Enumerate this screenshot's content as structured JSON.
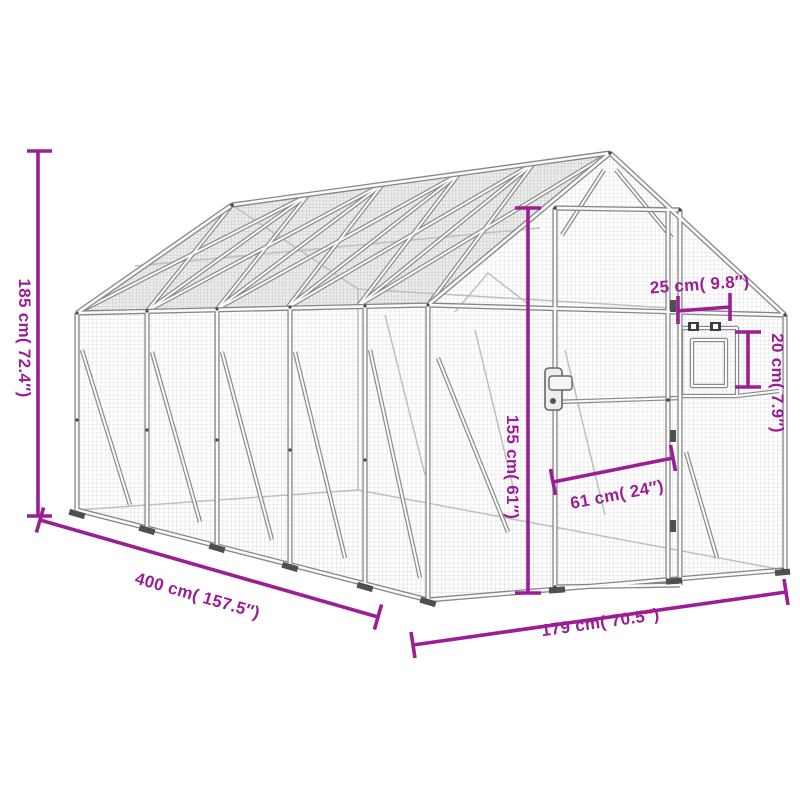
{
  "diagram": {
    "kind": "product-dimension-diagram",
    "subject": "aviary-cage-line-drawing"
  },
  "dimensions": {
    "overall_height": {
      "label": "185 cm( 72.4″)",
      "value_cm": 185,
      "value_in": 72.4
    },
    "overall_length": {
      "label": "400 cm( 157.5″)",
      "value_cm": 400,
      "value_in": 157.5
    },
    "front_width": {
      "label": "179 cm( 70.5″)",
      "value_cm": 179,
      "value_in": 70.5
    },
    "door_height": {
      "label": "155 cm( 61″)",
      "value_cm": 155,
      "value_in": 61
    },
    "door_width": {
      "label": "61 cm( 24″)",
      "value_cm": 61,
      "value_in": 24
    },
    "window_width": {
      "label": "25 cm( 9.8″)",
      "value_cm": 25,
      "value_in": 9.8
    },
    "window_height": {
      "label": "20 cm( 7.9″)",
      "value_cm": 20,
      "value_in": 7.9
    }
  },
  "colors": {
    "dimension": "#9C1D94",
    "frame_outline": "#878787",
    "frame_fill": "#fafafa",
    "mesh_line": "#c7c7c7",
    "background": "#ffffff"
  }
}
